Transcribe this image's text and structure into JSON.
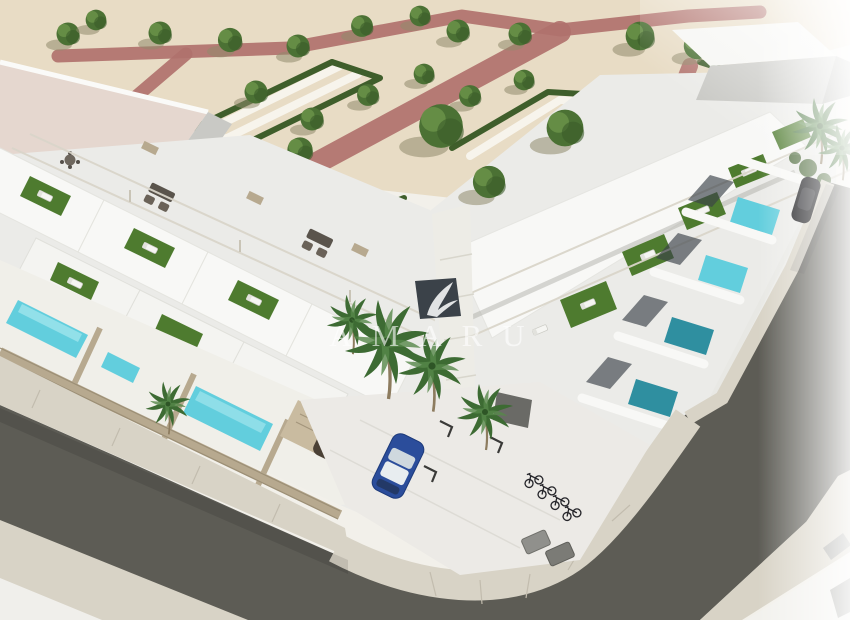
{
  "scene": {
    "alt": "Aerial 3D architectural rendering of a white residential development with rooftop terraces, private turquoise pools, a landscaped park with hedges and trees, parking with cars and bicycles, and surrounding asphalt streets"
  },
  "watermark": {
    "text": "AMARU",
    "logo_icon": "flame-swoosh-icon",
    "opacity": "0.62"
  },
  "colors": {
    "background": "#f2f0ea",
    "sand": "#e8dcc5",
    "pathred": "#b0716c",
    "pathwhite": "#f7f4ec",
    "hedge": "#3f5e2b",
    "tree": "#4b7134",
    "treehi": "#6a9249",
    "palm": "#3d6b33",
    "turf": "#4e7b2f",
    "bwhite": "#f8f8f6",
    "blight": "#ebebe8",
    "bshade": "#c9c9c5",
    "bdark": "#a9a9a4",
    "roofpink": "#e5d7cf",
    "window": "#3b4249",
    "pool": "#62cedd",
    "pooldeep": "#2f8fa0",
    "fence": "#b7a98f",
    "road": "#5d5c55",
    "sidewalk": "#d8d3c6",
    "carblue": "#2b4d9b",
    "cardark": "#4a4035",
    "carblack": "#131316",
    "watermark": "#ffffff"
  }
}
